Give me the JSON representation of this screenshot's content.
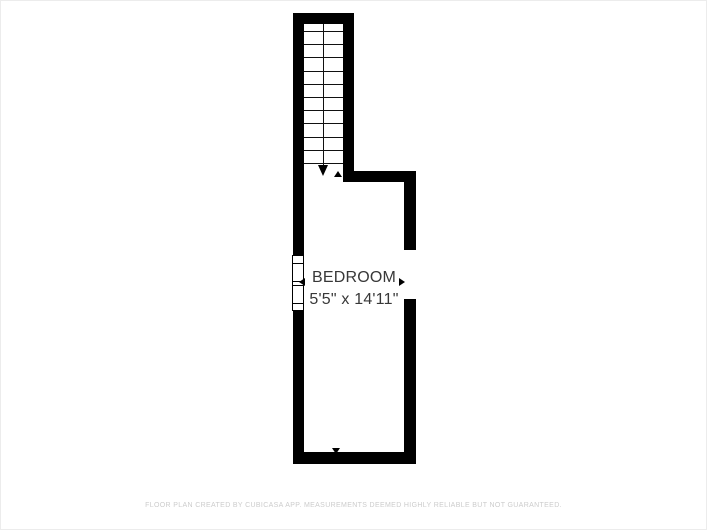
{
  "floorplan": {
    "room": {
      "name": "BEDROOM",
      "dimensions": "5'5\" x 14'11\""
    },
    "stairs": {
      "tread_count": 11,
      "direction": "down"
    },
    "colors": {
      "wall": "#000000",
      "room_text": "#383838",
      "footer_text": "#cccccc",
      "background": "#ffffff"
    }
  },
  "footer": {
    "disclaimer": "FLOOR PLAN CREATED BY CUBICASA APP. MEASUREMENTS DEEMED HIGHLY RELIABLE BUT NOT GUARANTEED."
  }
}
